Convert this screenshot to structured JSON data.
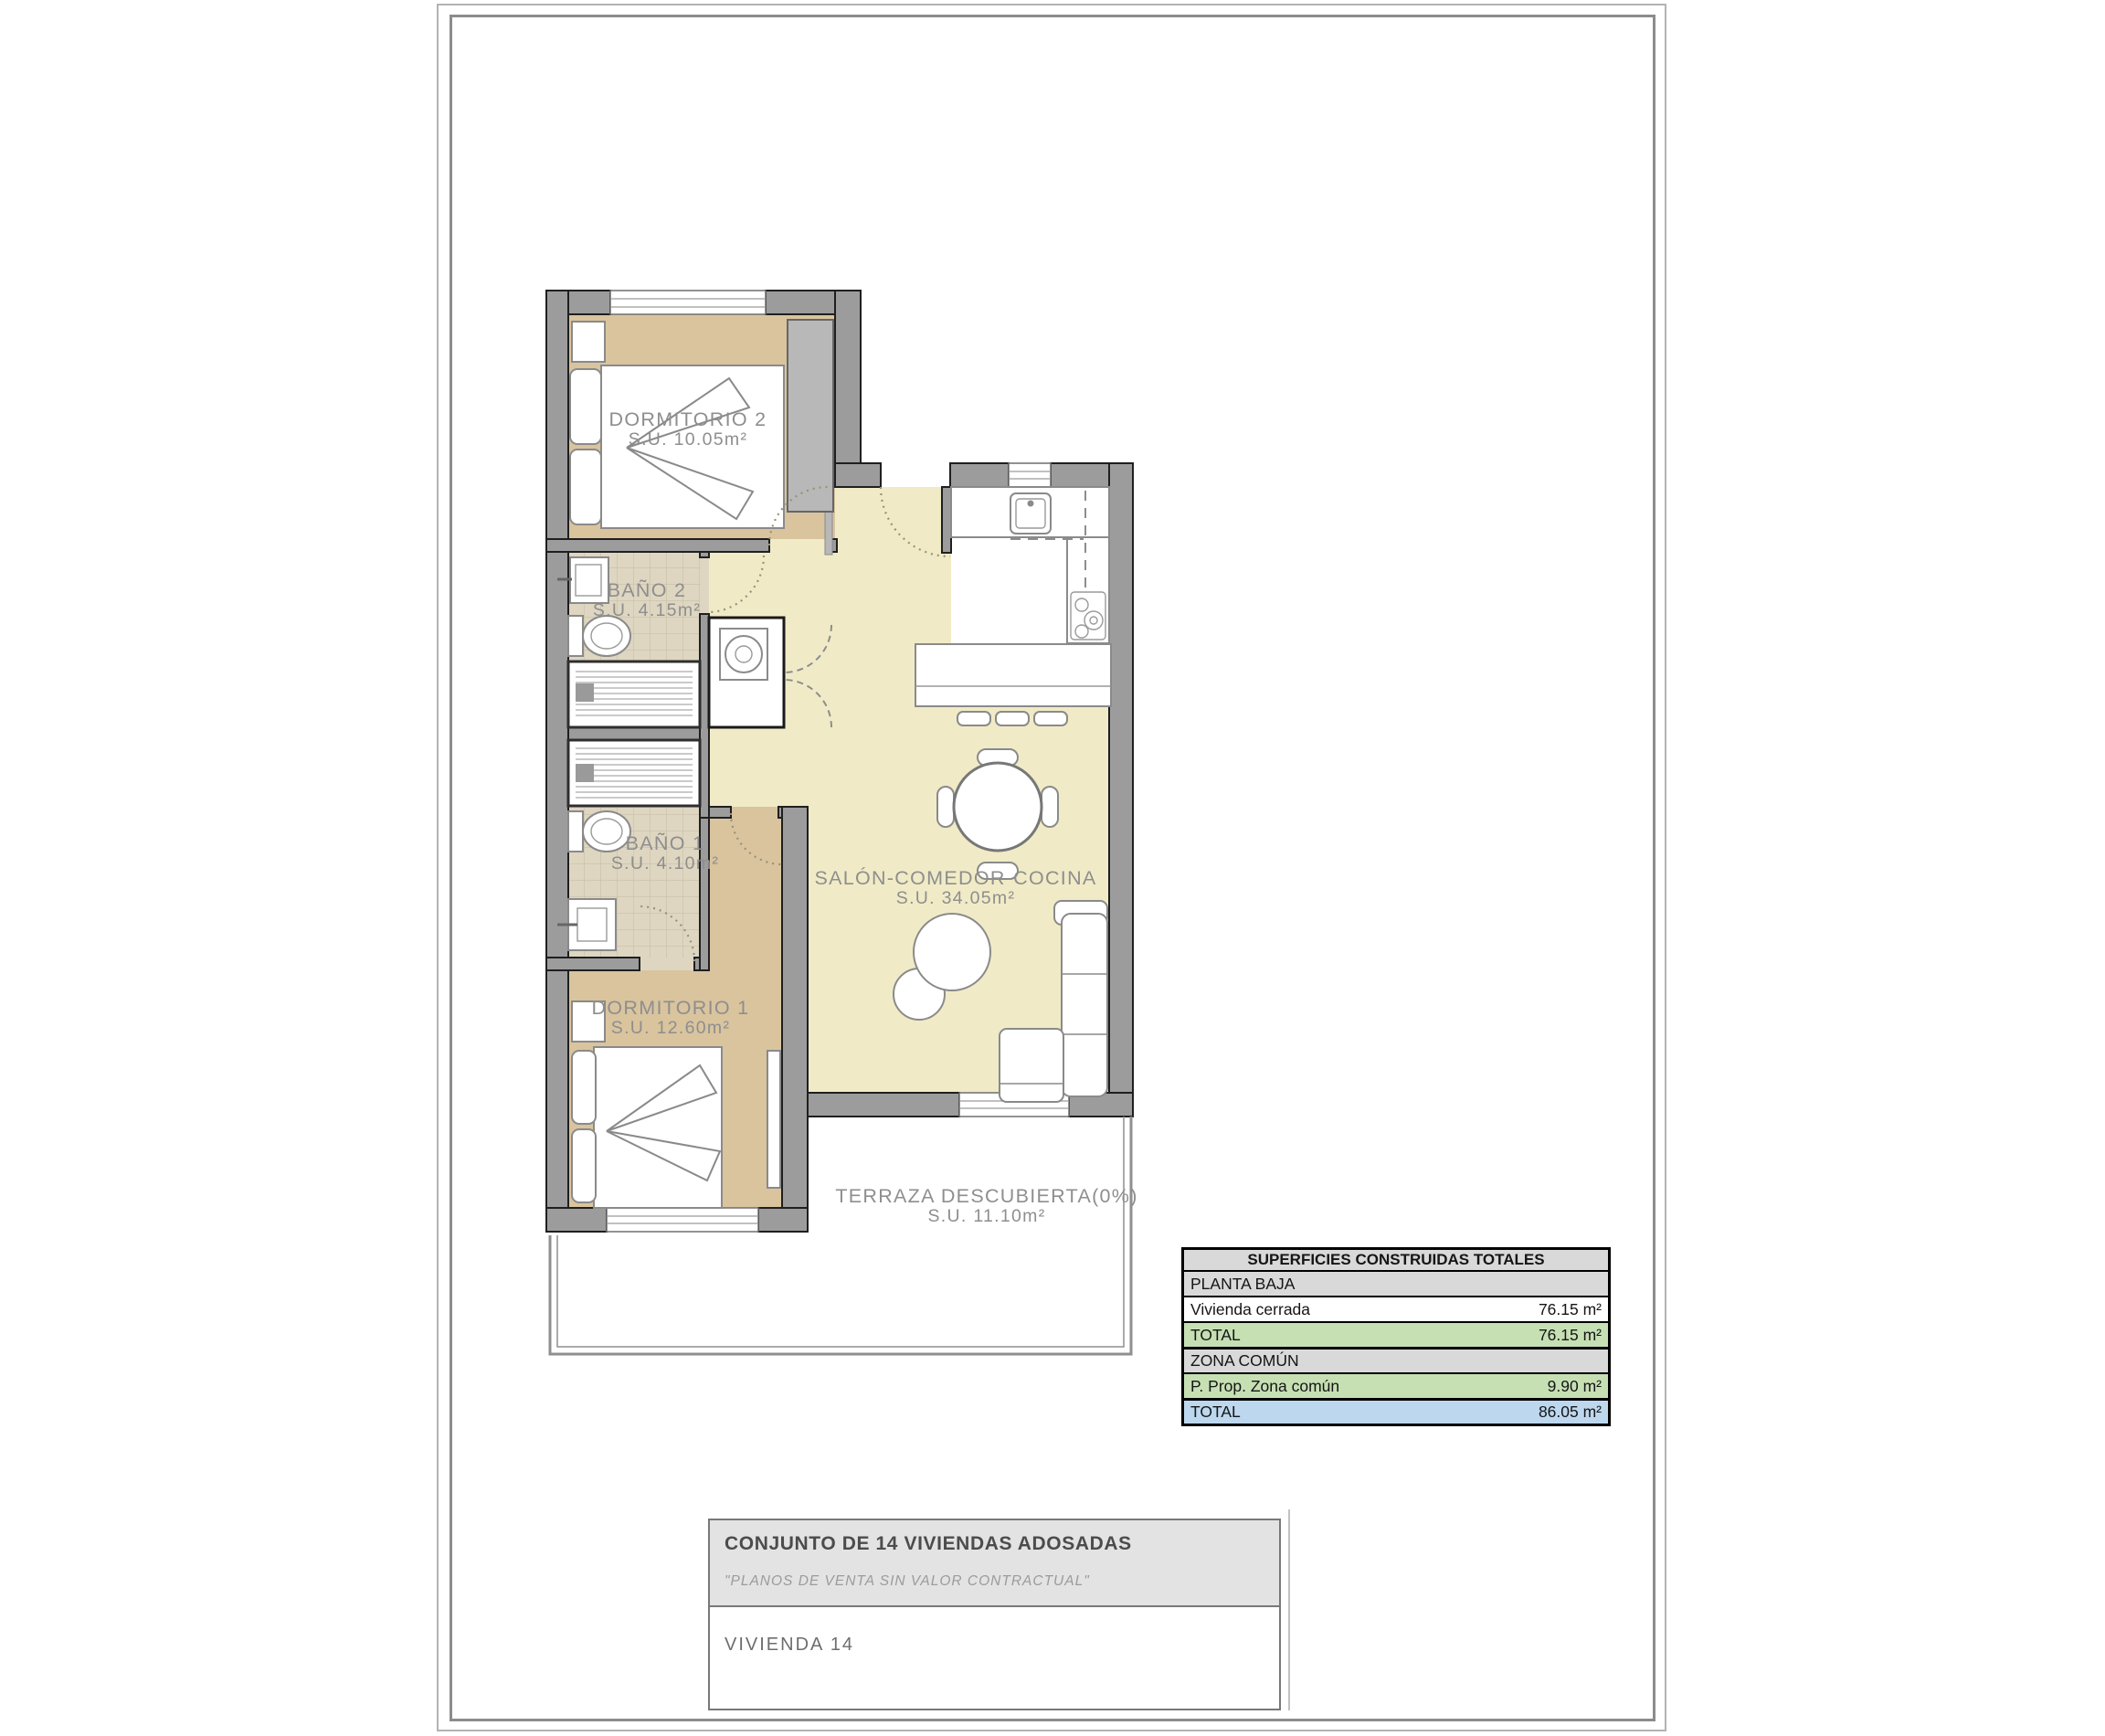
{
  "plan": {
    "rooms": [
      {
        "id": "dormitorio-2",
        "name": "DORMITORIO 2",
        "area": "S.U. 10.05m²"
      },
      {
        "id": "bano-2",
        "name": "BAÑO 2",
        "area": "S.U. 4.15m²"
      },
      {
        "id": "bano-1",
        "name": "BAÑO 1",
        "area": "S.U. 4.10m²"
      },
      {
        "id": "dormitorio-1",
        "name": "DORMITORIO 1",
        "area": "S.U. 12.60m²"
      },
      {
        "id": "salon-comedor-cocina",
        "name": "SALÓN-COMEDOR-COCINA",
        "area": "S.U. 34.05m²"
      },
      {
        "id": "terraza",
        "name": "TERRAZA DESCUBIERTA(0%)",
        "area": "S.U. 11.10m²"
      }
    ]
  },
  "areas_table": {
    "title": "SUPERFICIES CONSTRUIDAS TOTALES",
    "rows": [
      {
        "label": "PLANTA BAJA",
        "value": "",
        "style": "section"
      },
      {
        "label": "Vivienda cerrada",
        "value": "76.15 m²",
        "style": "plain"
      },
      {
        "label": "TOTAL",
        "value": "76.15 m²",
        "style": "green"
      },
      {
        "label": "ZONA COMÚN",
        "value": "",
        "style": "section"
      },
      {
        "label": "P. Prop. Zona común",
        "value": "9.90 m²",
        "style": "green"
      },
      {
        "label": "TOTAL",
        "value": "86.05 m²",
        "style": "blue"
      }
    ]
  },
  "title_block": {
    "project_title": "CONJUNTO DE 14 VIVIENDAS ADOSADAS",
    "disclaimer": "\"PLANOS DE VENTA SIN VALOR CONTRACTUAL\"",
    "unit_label": "VIVIENDA 14"
  },
  "colors": {
    "bedroom_floor": "#d9c49e",
    "living_floor": "#f0ebc6",
    "bath_floor": "#ded6c1",
    "wall_gray": "#9c9c9c",
    "table_gray": "#d9d9d9",
    "table_green": "#c6e0b4",
    "table_blue": "#bdd7ee"
  }
}
